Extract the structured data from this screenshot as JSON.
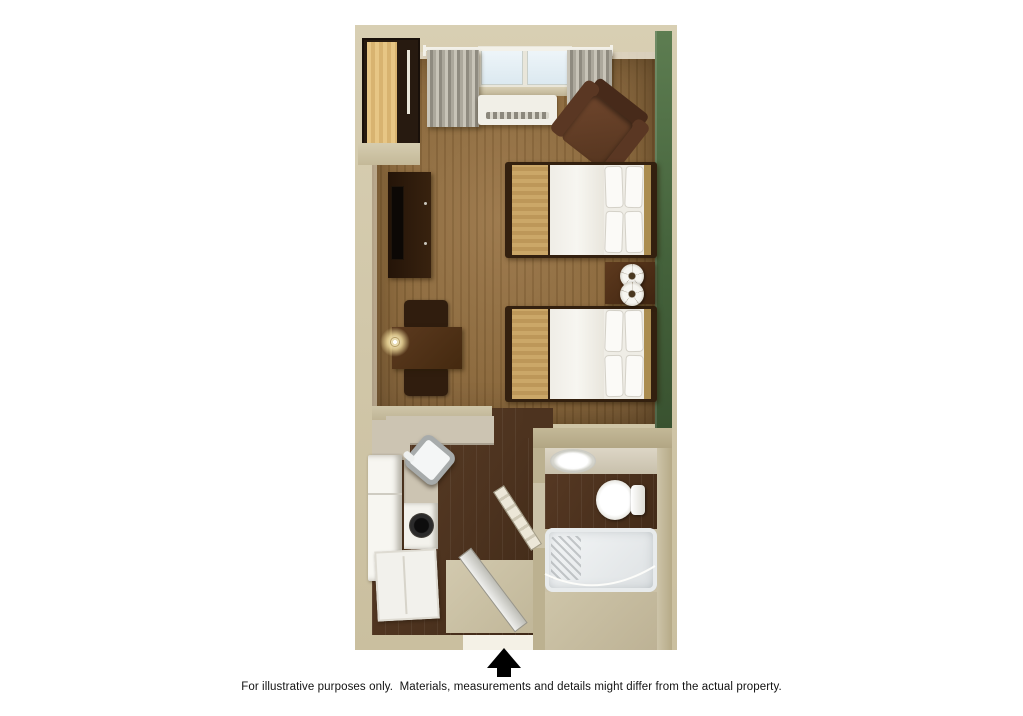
{
  "document": {
    "type": "hotel-room-floor-plan",
    "style": "3d-top-down-rendering",
    "caption": "For illustrative purposes only.  Materials, measurements and details might differ from the actual property."
  },
  "colors": {
    "wall": "#cfc5a6",
    "wall-dark": "#bfb494",
    "carpet": "#8a673a",
    "wood": "#4d331f",
    "green": "#486540",
    "counter": "#ccc4b2",
    "furn-dark": "#2e1b0f",
    "furn-brown": "#5a3723",
    "tan": "#c49f63",
    "page": "#ffffff"
  },
  "icons": {
    "entry_arrow": "up-arrow-solid-black"
  },
  "rooms": [
    {
      "name": "bedroom-living-area",
      "floor": "brown carpet",
      "accent_wall": "green, right side"
    },
    {
      "name": "kitchenette",
      "floor": "dark wood planks"
    },
    {
      "name": "bathroom",
      "floor": "dark wood + beige"
    }
  ],
  "furniture": [
    {
      "name": "closet-shelving",
      "location": "top-left nook",
      "finish": "light maple"
    },
    {
      "name": "window-with-curtains",
      "location": "top wall center"
    },
    {
      "name": "ac-unit",
      "location": "below window"
    },
    {
      "name": "armchair",
      "location": "top-right corner",
      "finish": "dark brown"
    },
    {
      "name": "bed-1",
      "type": "queen bed, white bedding, tan runner",
      "headboard": "against green wall"
    },
    {
      "name": "bed-2",
      "type": "queen bed, white bedding, tan runner",
      "headboard": "against green wall"
    },
    {
      "name": "nightstand-with-two-lamps",
      "location": "between beds"
    },
    {
      "name": "tv-dresser",
      "location": "left wall"
    },
    {
      "name": "dining-table-two-chairs-lamp",
      "location": "left wall"
    },
    {
      "name": "kitchen-counter-with-corner-sink"
    },
    {
      "name": "refrigerator"
    },
    {
      "name": "stove-cooktop"
    },
    {
      "name": "base-cabinet"
    },
    {
      "name": "entry-door",
      "state": "open"
    },
    {
      "name": "bathroom-door",
      "state": "open"
    },
    {
      "name": "bathroom-sink"
    },
    {
      "name": "toilet"
    },
    {
      "name": "bathtub-with-shower-curtain"
    }
  ]
}
